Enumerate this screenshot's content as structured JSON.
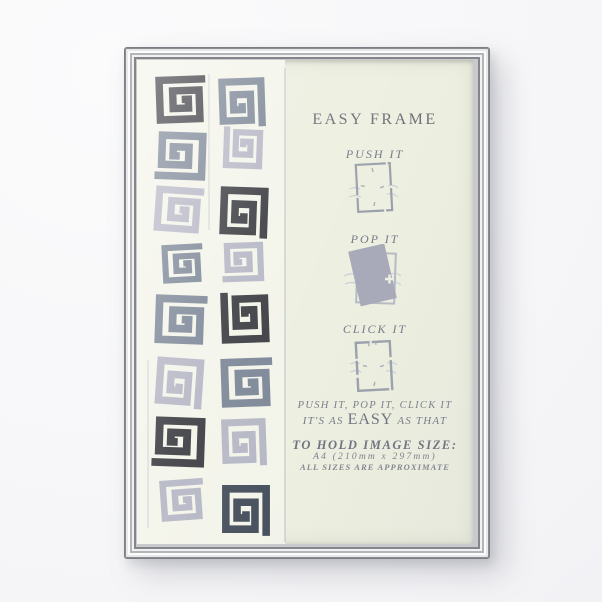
{
  "product": {
    "name": "silver easy photo frame",
    "colors": {
      "chrome": "#d6d7da",
      "paper": "#edefe0",
      "pattern_paper": "#f3f4ea",
      "text_grey": "#6f7280",
      "pattern_dark": "#3e3f44",
      "pattern_slate": "#7e8898",
      "pattern_lavender": "#b7b8c6",
      "pattern_darkslate": "#4a5260",
      "pop_fill": "#a8aaba"
    },
    "insert": {
      "title": "EASY FRAME",
      "steps": [
        {
          "label": "PUSH IT",
          "icon": "push-frame-icon"
        },
        {
          "label": "POP IT",
          "icon": "pop-frame-icon"
        },
        {
          "label": "CLICK IT",
          "icon": "click-frame-icon"
        }
      ],
      "tagline_line1": "PUSH IT, POP IT, CLICK IT",
      "tagline_line2": {
        "pre": "IT'S AS",
        "emphasis": "EASY",
        "post": "AS THAT"
      },
      "size_heading": "TO HOLD IMAGE SIZE:",
      "size_value": "A4 (210mm x 297mm)",
      "size_note": "ALL SIZES ARE APPROXIMATE"
    },
    "pattern": {
      "cells": [
        {
          "x": 42,
          "y": 39,
          "s": 55,
          "r": -2,
          "c": "pattern_dark"
        },
        {
          "x": 105,
          "y": 41,
          "s": 54,
          "r": 88,
          "c": "pattern_slate"
        },
        {
          "x": 45,
          "y": 96,
          "s": 56,
          "r": 182,
          "c": "pattern_slate"
        },
        {
          "x": 106,
          "y": 89,
          "s": 46,
          "r": -88,
          "c": "pattern_lavender"
        },
        {
          "x": 40,
          "y": 149,
          "s": 53,
          "r": 4,
          "c": "pattern_lavender"
        },
        {
          "x": 107,
          "y": 151,
          "s": 56,
          "r": 92,
          "c": "pattern_dark"
        },
        {
          "x": 44,
          "y": 203,
          "s": 45,
          "r": -3,
          "c": "pattern_slate"
        },
        {
          "x": 107,
          "y": 202,
          "s": 46,
          "r": 178,
          "c": "pattern_lavender"
        },
        {
          "x": 42,
          "y": 259,
          "s": 57,
          "r": 2,
          "c": "pattern_slate"
        },
        {
          "x": 108,
          "y": 259,
          "s": 56,
          "r": -92,
          "c": "pattern_dark"
        },
        {
          "x": 42,
          "y": 321,
          "s": 55,
          "r": 94,
          "c": "pattern_lavender"
        },
        {
          "x": 108,
          "y": 322,
          "s": 57,
          "r": -2,
          "c": "pattern_slate"
        },
        {
          "x": 43,
          "y": 382,
          "s": 58,
          "r": 182,
          "c": "pattern_dark"
        },
        {
          "x": 107,
          "y": 381,
          "s": 52,
          "r": 88,
          "c": "pattern_lavender"
        },
        {
          "x": 44,
          "y": 440,
          "s": 48,
          "r": -4,
          "c": "pattern_lavender"
        },
        {
          "x": 109,
          "y": 449,
          "s": 56,
          "r": 90,
          "c": "pattern_darkslate"
        }
      ]
    }
  }
}
